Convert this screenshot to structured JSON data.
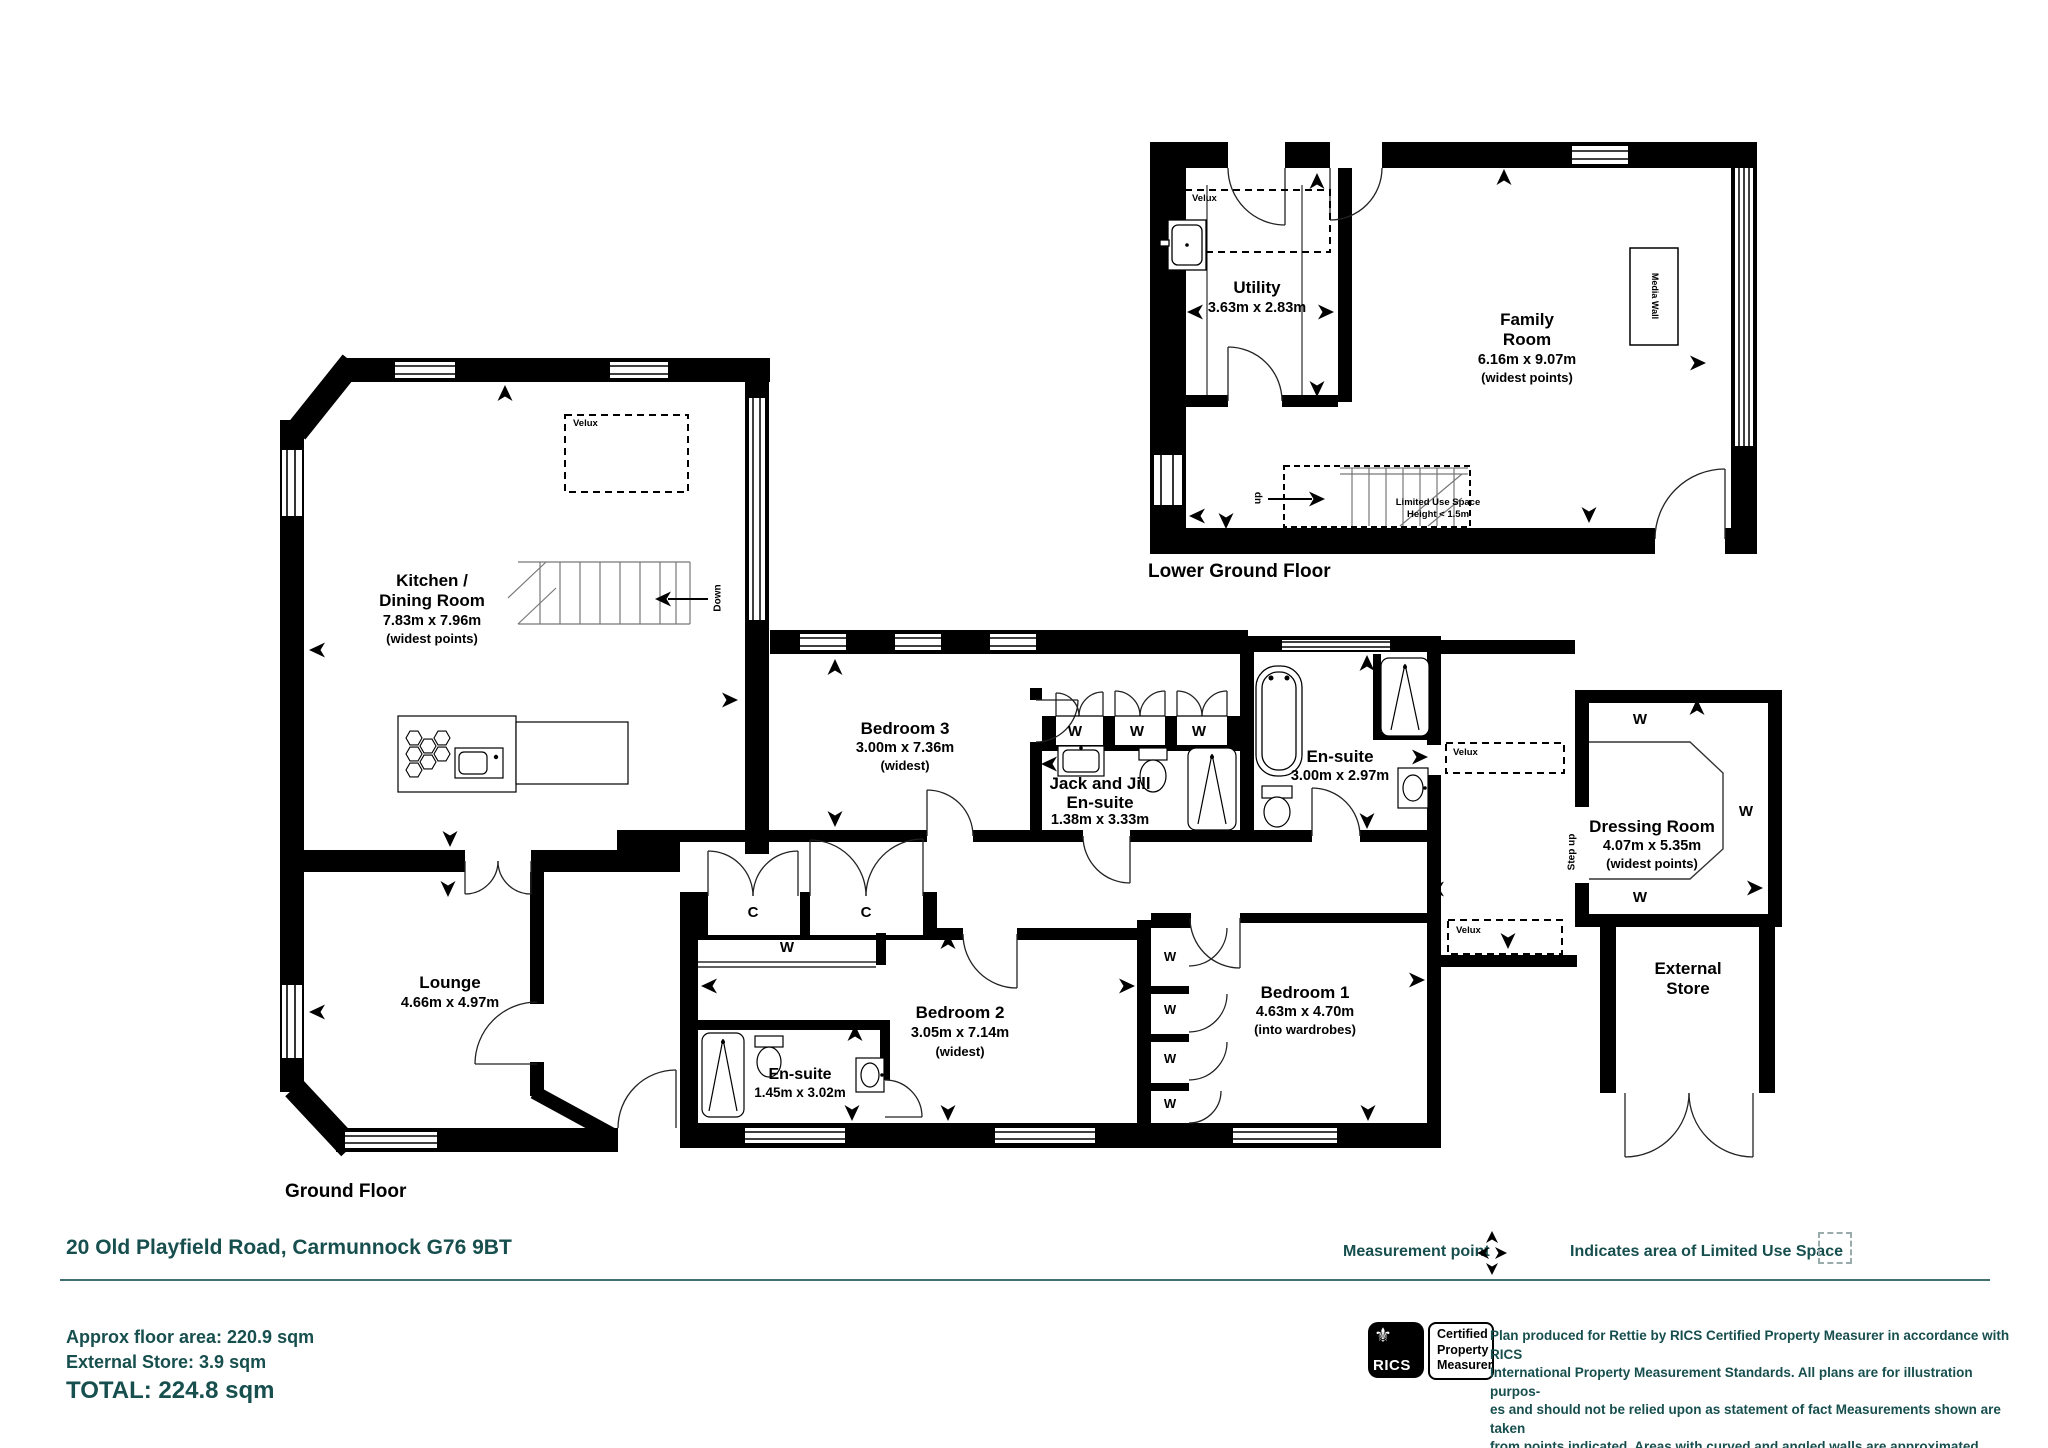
{
  "colors": {
    "accent_teal": "#174e4e",
    "plan_black": "#000000"
  },
  "floors": {
    "lower": {
      "title": "Lower Ground Floor",
      "rooms": {
        "utility": {
          "name": "Utility",
          "dims": "3.63m x 2.83m"
        },
        "family": {
          "name_line1": "Family",
          "name_line2": "Room",
          "dims": "6.16m x 9.07m",
          "note": "(widest points)"
        }
      },
      "media_wall": "Media Wall",
      "velux": "Velux",
      "stairs_up": "up",
      "limited_line1": "Limited Use Space",
      "limited_line2": "Height < 1.5m"
    },
    "ground": {
      "title": "Ground Floor",
      "rooms": {
        "kitchen": {
          "name_line1": "Kitchen /",
          "name_line2": "Dining Room",
          "dims": "7.83m x 7.96m",
          "note": "(widest points)"
        },
        "lounge": {
          "name": "Lounge",
          "dims": "4.66m x 4.97m"
        },
        "bedroom3": {
          "name": "Bedroom 3",
          "dims": "3.00m x 7.36m",
          "note": "(widest)"
        },
        "jackjill": {
          "name_line1": "Jack and Jill",
          "name_line2": "En-suite",
          "dims": "1.38m x 3.33m"
        },
        "ensuite_master": {
          "name": "En-suite",
          "dims": "3.00m x 2.97m"
        },
        "bedroom2": {
          "name": "Bedroom 2",
          "dims": "3.05m x 7.14m",
          "note": "(widest)"
        },
        "ensuite2": {
          "name": "En-suite",
          "dims": "1.45m x 3.02m"
        },
        "bedroom1": {
          "name": "Bedroom 1",
          "dims": "4.63m x 4.70m",
          "note": "(into wardrobes)"
        },
        "dressing": {
          "name": "Dressing Room",
          "dims": "4.07m x 5.35m",
          "note": "(widest points)"
        },
        "external_store": {
          "name_line1": "External",
          "name_line2": "Store"
        }
      },
      "stairs_down": "Down",
      "step_up": "Step up",
      "velux": "Velux",
      "wardrobe": "W",
      "closet": "C"
    }
  },
  "footer": {
    "address": "20 Old Playfield Road, Carmunnock G76 9BT",
    "measurement_point": "Measurement point",
    "limited_use_legend": "Indicates area of  Limited Use Space",
    "area_line1": "Approx floor area: 220.9 sqm",
    "area_line2": "External Store: 3.9 sqm",
    "total": "TOTAL: 224.8 sqm",
    "rics": {
      "logo": "RICS",
      "cert_line1": "Certified",
      "cert_line2": "Property",
      "cert_line3": "Measurer"
    },
    "disclaimer_lines": [
      "Plan produced for Rettie by RICS Certified Property Measurer in accordance with RICS",
      "International Property  Measurement Standards.  All plans are for illustration purpos-",
      "es and should not be relied upon as statement of fact Measurements shown are taken",
      "from points indicated. Areas with curved and angled walls are approximated."
    ]
  }
}
